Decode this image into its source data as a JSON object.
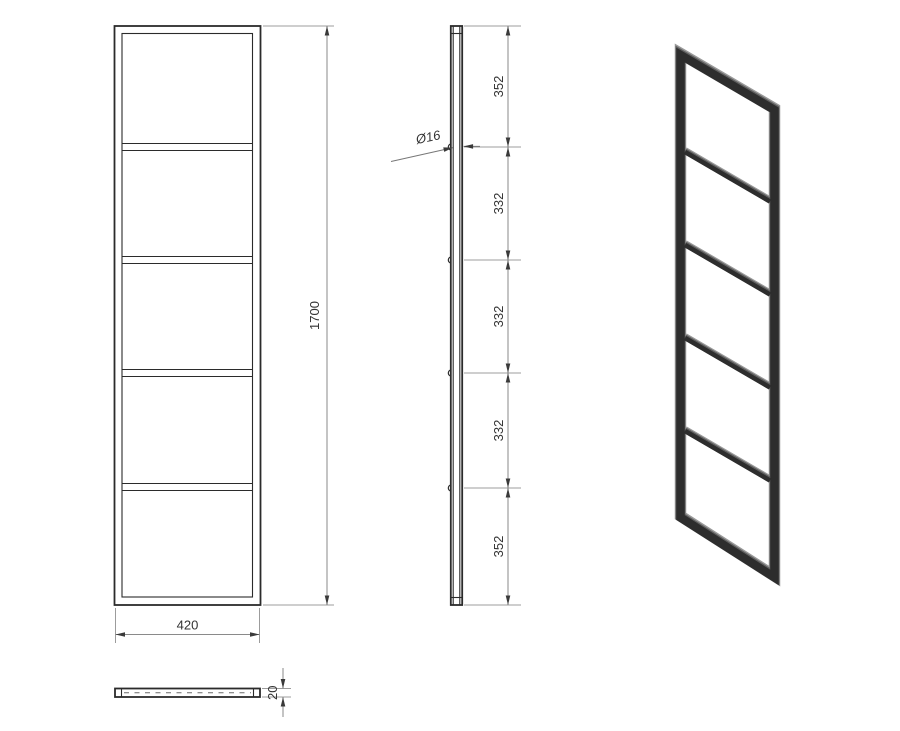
{
  "front": {
    "width_label": "420",
    "height_label": "1700"
  },
  "side": {
    "segments": [
      "352",
      "332",
      "332",
      "332",
      "352"
    ],
    "diameter_label": "Ø16"
  },
  "bottom": {
    "thickness_label": "20"
  },
  "colors": {
    "outline": "#2b2b2b",
    "dimension_line": "#8a8a8a",
    "extension_line": "#9c9c9c",
    "arrow": "#3a3a3a",
    "text": "#333333",
    "iso_dark": "#2d2d2d",
    "iso_mid": "#606060",
    "iso_light": "#9a9a9a",
    "background": "#ffffff"
  }
}
